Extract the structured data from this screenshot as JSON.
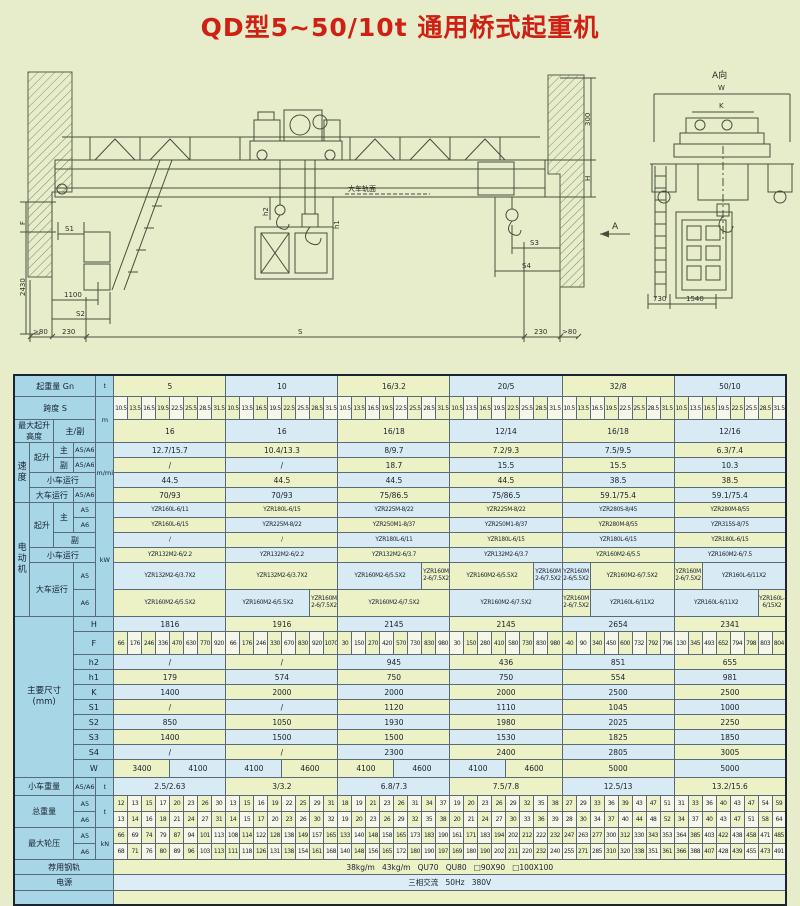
{
  "title": "QD型5~50/10t 通用桥式起重机",
  "colors": {
    "title_red": "#cf2014",
    "label_blue": "#a7d7e7",
    "cell_yellow": "#edf2c6",
    "cell_blue": "#d8eaf3",
    "background": "#e7edca"
  },
  "drawing": {
    "labels": {
      "view_a": "A向",
      "w": "W",
      "k": "K",
      "d300": "300",
      "h": "H",
      "f": "F",
      "d2430": "2430",
      "s1": "S1",
      "d1100": "1100",
      "s2": "S2",
      "gt80l": ">80",
      "d230l": "230",
      "s": "S",
      "d230r": "230",
      "gt80r": ">80",
      "s3": "S3",
      "s4": "S4",
      "d730": "730",
      "d1540": "1540",
      "h1": "h1",
      "h2": "h2",
      "rail_surface": "大车轨面",
      "section_a": "A"
    }
  },
  "table": {
    "groups": [
      "5",
      "10",
      "16/3.2",
      "20/5",
      "32/8",
      "50/10"
    ],
    "header": {
      "capacity": "起重量 Gn",
      "capacity_unit": "t",
      "span": "跨度 S",
      "span_unit": "m",
      "lift": "最大起升高度",
      "lift_sub": "主/副"
    },
    "span_values": [
      "10.5",
      "13.5",
      "16.5",
      "19.5",
      "22.5",
      "25.5",
      "28.5",
      "31.5"
    ],
    "lift_height": [
      "16",
      "16",
      "16/18",
      "12/14",
      "16/18",
      "12/16"
    ],
    "speed": {
      "section": "速度",
      "unit": "m/min",
      "labels": {
        "hoist": "起升",
        "main": "主",
        "aux": "副",
        "grade": "A5/A6",
        "trolley": "小车运行",
        "bridge": "大车运行"
      },
      "rows": [
        {
          "values": [
            "12.7/15.7",
            "10.4/13.3",
            "8/9.7",
            "7.2/9.3",
            "7.5/9.5",
            "6.3/7.4"
          ]
        },
        {
          "values": [
            "/",
            "/",
            "18.7",
            "15.5",
            "15.5",
            "10.3"
          ]
        },
        {
          "values": [
            "44.5",
            "44.5",
            "44.5",
            "44.5",
            "38.5",
            "38.5"
          ]
        },
        {
          "values": [
            "70/93",
            "70/93",
            "75/86.5",
            "75/86.5",
            "59.1/75.4",
            "59.1/75.4"
          ]
        }
      ]
    },
    "motor": {
      "section": "电动机",
      "unit": "kW",
      "labels": {
        "hoist": "起升",
        "main": "主",
        "aux": "副",
        "a5": "A5",
        "a6": "A6",
        "trolley": "小车运行",
        "bridge": "大车运行"
      },
      "rows": [
        {
          "cells": [
            [
              "YZR160L-6/11"
            ],
            [
              "YZR180L-6/15"
            ],
            [
              "YZR225M-8/22"
            ],
            [
              "YZR225M-8/22"
            ],
            [
              "YZR280S-8/45"
            ],
            [
              "YZR280M-8/55"
            ]
          ]
        },
        {
          "cells": [
            [
              "YZR160L-6/15"
            ],
            [
              "YZR225M-8/22"
            ],
            [
              "YZR250M1-8/37"
            ],
            [
              "YZR250M1-8/37"
            ],
            [
              "YZR280M-8/55"
            ],
            [
              "YZR315S-8/75"
            ]
          ]
        },
        {
          "cells": [
            [
              "/"
            ],
            [
              "/"
            ],
            [
              "YZR180L-6/11"
            ],
            [
              "YZR180L-6/15"
            ],
            [
              "YZR180L-6/15"
            ],
            [
              "YZR180L-6/15"
            ]
          ]
        },
        {
          "cells": [
            [
              "YZR132M2-6/2.2"
            ],
            [
              "YZR132M2-6/2.2"
            ],
            [
              "YZR132M2-6/3.7"
            ],
            [
              "YZR132M2-6/3.7"
            ],
            [
              "YZR160M2-6/5.5"
            ],
            [
              "YZR160M2-6/7.5"
            ]
          ]
        },
        {
          "cells": [
            [
              "YZR132M2-6/3.7X2"
            ],
            [
              "YZR132M2-6/3.7X2"
            ],
            [
              "YZR160M2-6/5.5X2",
              "YZR160M2-6/7.5X2"
            ],
            [
              "YZR160M2-6/5.5X2",
              "YZR160M2-6/7.5X2"
            ],
            [
              "YZR160M2-6/5.5X2",
              "YZR160M2-6/7.5X2"
            ],
            [
              "YZR160M2-6/7.5X2",
              "YZR160L-6/11X2"
            ]
          ]
        },
        {
          "cells": [
            [
              "YZR160M2-6/5.5X2"
            ],
            [
              "YZR160M2-6/5.5X2",
              "YZR160M2-6/7.5X2"
            ],
            [
              "YZR160M2-6/7.5X2"
            ],
            [
              "YZR160M2-6/7.5X2"
            ],
            [
              "YZR160M2-6/7.5X2",
              "YZR160L-6/11X2"
            ],
            [
              "YZR160L-6/11X2",
              "YZR160L-6/15X2"
            ]
          ]
        }
      ]
    },
    "dims": {
      "section": "主要尺寸",
      "section_unit": "(mm)",
      "rows": [
        {
          "label": "H",
          "type": "full",
          "values": [
            "1816",
            "1916",
            "2145",
            "2145",
            "2654",
            "2341"
          ]
        },
        {
          "label": "F",
          "type": "multi",
          "values": [
            [
              "66",
              "176",
              "246",
              "336",
              "470",
              "630",
              "770",
              "920"
            ],
            [
              "66",
              "176",
              "246",
              "330",
              "670",
              "830",
              "920",
              "1070"
            ],
            [
              "30",
              "150",
              "270",
              "420",
              "570",
              "730",
              "830",
              "980"
            ],
            [
              "30",
              "150",
              "280",
              "410",
              "580",
              "730",
              "830",
              "980"
            ],
            [
              "-40",
              "90",
              "340",
              "450",
              "600",
              "732",
              "792",
              "796"
            ],
            [
              "130",
              "345",
              "493",
              "652",
              "794",
              "798",
              "803",
              "804"
            ]
          ]
        },
        {
          "label": "h2",
          "type": "full",
          "values": [
            "/",
            "/",
            "945",
            "436",
            "851",
            "655"
          ]
        },
        {
          "label": "h1",
          "type": "full",
          "values": [
            "179",
            "574",
            "750",
            "750",
            "554",
            "981"
          ]
        },
        {
          "label": "K",
          "type": "full",
          "values": [
            "1400",
            "2000",
            "2000",
            "2000",
            "2500",
            "2500"
          ]
        },
        {
          "label": "S1",
          "type": "full",
          "values": [
            "/",
            "/",
            "1120",
            "1110",
            "1045",
            "1000"
          ]
        },
        {
          "label": "S2",
          "type": "full",
          "values": [
            "850",
            "1050",
            "1930",
            "1980",
            "2025",
            "2250"
          ]
        },
        {
          "label": "S3",
          "type": "full",
          "values": [
            "1400",
            "1500",
            "1500",
            "1530",
            "1825",
            "1850"
          ]
        },
        {
          "label": "S4",
          "type": "full",
          "values": [
            "/",
            "/",
            "2300",
            "2400",
            "2805",
            "3005"
          ]
        },
        {
          "label": "W",
          "type": "split",
          "values": [
            [
              "3400",
              "4100"
            ],
            [
              "4100",
              "4600"
            ],
            [
              "4100",
              "4600"
            ],
            [
              "4100",
              "4600"
            ],
            [
              "5000"
            ],
            [
              "5000"
            ]
          ]
        }
      ]
    },
    "trolley_weight": {
      "label": "小车重量",
      "sub": "A5/A6",
      "unit": "t",
      "values": [
        "2.5/2.63",
        "3/3.2",
        "6.8/7.3",
        "7.5/7.8",
        "12.5/13",
        "13.2/15.6"
      ]
    },
    "total_weight": {
      "label": "总重量",
      "subs": [
        "A5",
        "A6"
      ],
      "unit": "t",
      "rows": [
        {
          "values": [
            [
              "12",
              "13",
              "15",
              "17",
              "20",
              "23",
              "26",
              "30"
            ],
            [
              "13",
              "15",
              "16",
              "19",
              "22",
              "25",
              "29",
              "31"
            ],
            [
              "18",
              "19",
              "21",
              "23",
              "26",
              "31",
              "34",
              "37"
            ],
            [
              "19",
              "20",
              "23",
              "26",
              "29",
              "32",
              "35",
              "38"
            ],
            [
              "27",
              "29",
              "33",
              "36",
              "39",
              "43",
              "47",
              "51"
            ],
            [
              "31",
              "33",
              "36",
              "40",
              "43",
              "47",
              "54",
              "59"
            ]
          ]
        },
        {
          "values": [
            [
              "13",
              "14",
              "16",
              "18",
              "21",
              "24",
              "27",
              "31"
            ],
            [
              "14",
              "15",
              "17",
              "20",
              "23",
              "26",
              "30",
              "32"
            ],
            [
              "19",
              "20",
              "23",
              "26",
              "29",
              "32",
              "35",
              "38"
            ],
            [
              "20",
              "21",
              "24",
              "27",
              "30",
              "33",
              "36",
              "39"
            ],
            [
              "28",
              "30",
              "34",
              "37",
              "40",
              "44",
              "48",
              "52"
            ],
            [
              "34",
              "37",
              "40",
              "43",
              "47",
              "51",
              "58",
              "64"
            ]
          ]
        }
      ]
    },
    "wheel_load": {
      "label": "最大轮压",
      "subs": [
        "A5",
        "A6"
      ],
      "unit": "kN",
      "rows": [
        {
          "values": [
            [
              "66",
              "69",
              "74",
              "79",
              "87",
              "94",
              "101",
              "113"
            ],
            [
              "108",
              "114",
              "122",
              "128",
              "138",
              "149",
              "157",
              "165"
            ],
            [
              "133",
              "140",
              "148",
              "158",
              "165",
              "173",
              "183",
              "190"
            ],
            [
              "161",
              "171",
              "183",
              "194",
              "202",
              "212",
              "222",
              "232"
            ],
            [
              "247",
              "263",
              "277",
              "300",
              "312",
              "330",
              "343",
              "353"
            ],
            [
              "364",
              "385",
              "403",
              "422",
              "438",
              "458",
              "471",
              "485"
            ]
          ]
        },
        {
          "values": [
            [
              "68",
              "71",
              "76",
              "80",
              "89",
              "96",
              "103",
              "113"
            ],
            [
              "111",
              "118",
              "126",
              "131",
              "138",
              "154",
              "161",
              "168"
            ],
            [
              "140",
              "148",
              "156",
              "165",
              "172",
              "180",
              "190",
              "197"
            ],
            [
              "169",
              "180",
              "190",
              "202",
              "211",
              "220",
              "232",
              "240"
            ],
            [
              "255",
              "271",
              "285",
              "310",
              "320",
              "338",
              "351",
              "361"
            ],
            [
              "366",
              "388",
              "407",
              "428",
              "439",
              "455",
              "473",
              "491"
            ]
          ]
        }
      ]
    },
    "rail": {
      "label": "荐用钢轨",
      "value": "38kg/m   43kg/m   QU70   QU80   □90X90   □100X100"
    },
    "power": {
      "label": "电源",
      "value": "三相交流   50Hz   380V"
    }
  }
}
